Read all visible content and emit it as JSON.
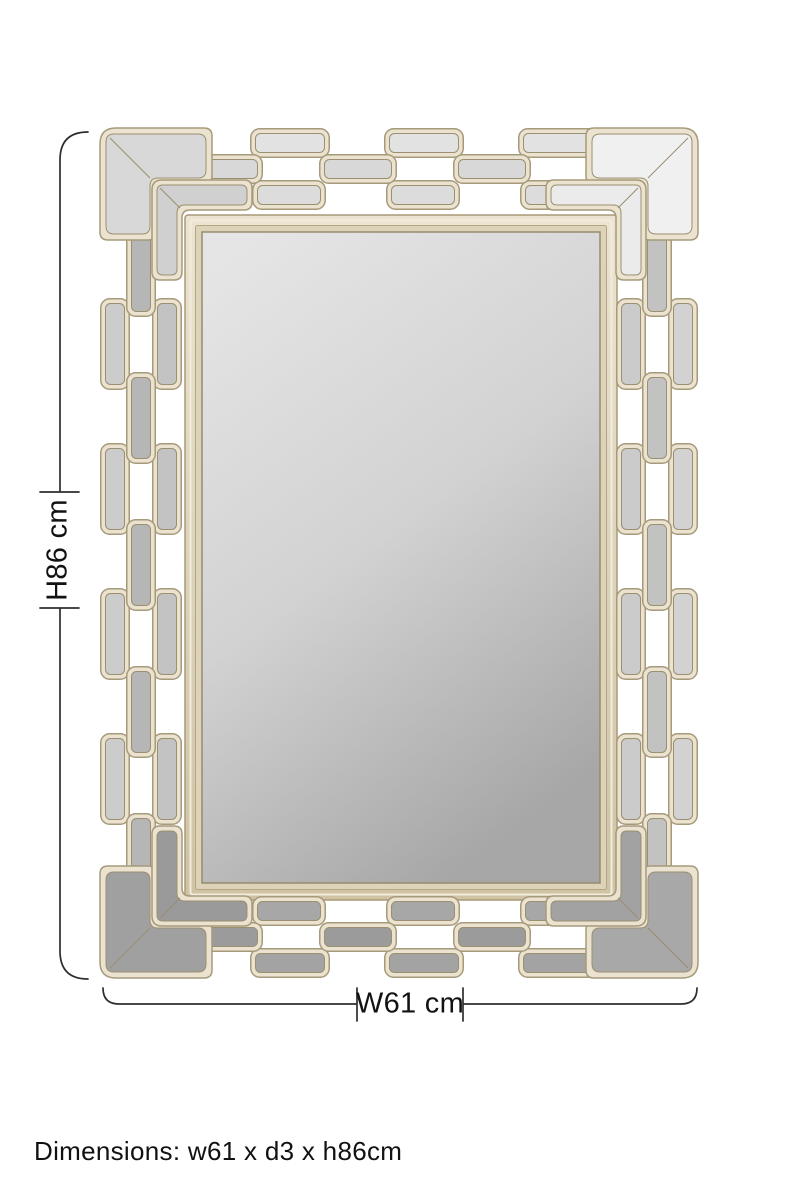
{
  "page": {
    "background": "#ffffff"
  },
  "annotations": {
    "height_label": "H86 cm",
    "width_label": "W61 cm",
    "caption": "Dimensions: w61 x d3 x h86cm",
    "line_color": "#2e2e2e",
    "text_color": "#121212"
  },
  "mirror": {
    "metal": "#ebe3d0",
    "metal_outline": "#a69a7b",
    "panel_stroke": "#9a8f70",
    "frame_light": "#ece4d1",
    "frame_base": "#ddd3b9",
    "frame_dark": "#cfc3a4",
    "frame_outline": "#a89a78",
    "frame_highlight": "#f2ecdc",
    "glass_top": "#e5e5e5",
    "glass_mid": "#d2d2d2",
    "glass_bottom": "#a7a7a7",
    "glass_edge": "#978b6d",
    "panels": {
      "top_rows": [
        "#e2e2e2",
        "#d8d8d8",
        "#dcdcdc"
      ],
      "bottom_rows": [
        "#a3a3a3",
        "#9b9b9b",
        "#a7a7a7"
      ],
      "left_cols": [
        "#cccccc",
        "#b6b6b6",
        "#c3c3c3"
      ],
      "right_cols": [
        "#d2d2d2",
        "#c2c2c2",
        "#cbcbcb"
      ],
      "corner_tl": "#d8d8d8",
      "corner_tr": "#f0f0f0",
      "corner_bl": "#a0a0a0",
      "corner_br": "#a8a8a8",
      "corner_tl_inner": "#d0d0d0",
      "corner_tr_inner": "#ebebeb",
      "corner_bl_inner": "#9a9a9a",
      "corner_br_inner": "#a2a2a2"
    }
  }
}
